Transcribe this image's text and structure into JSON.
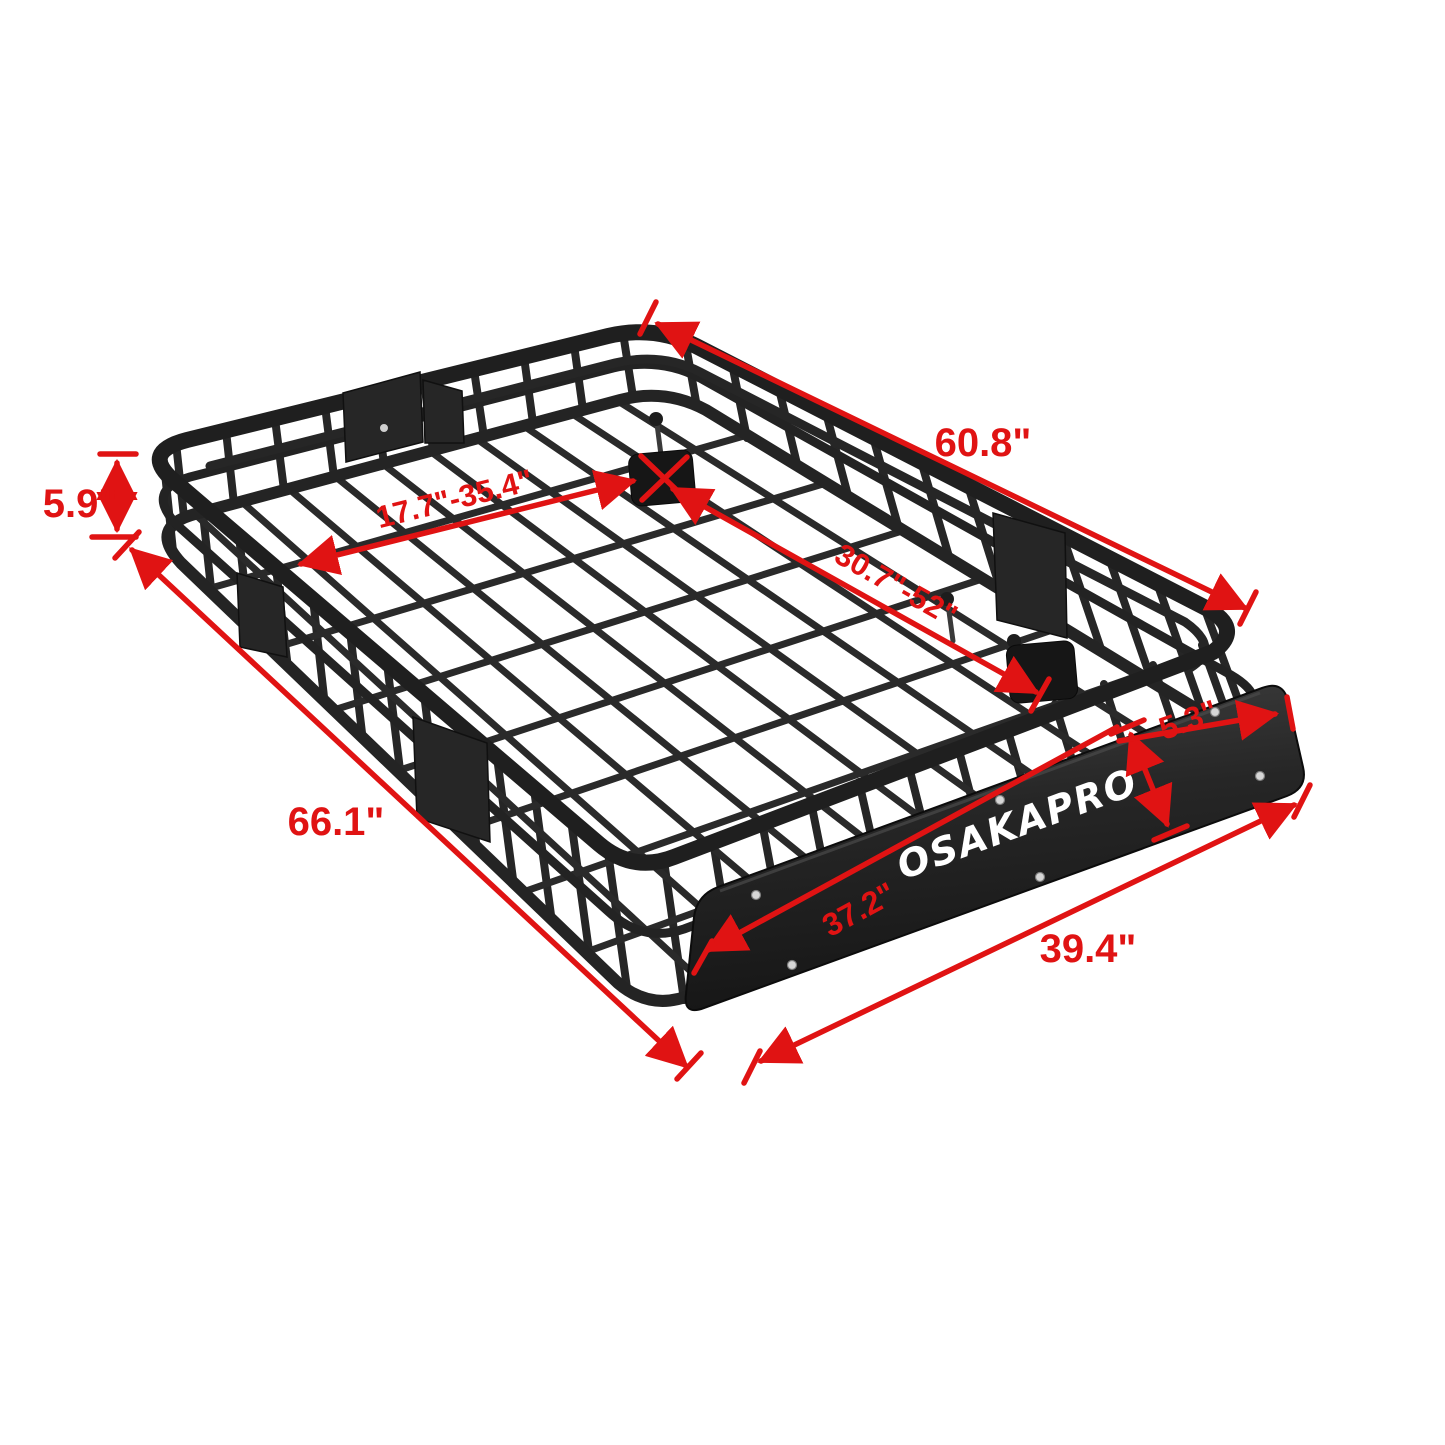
{
  "product": {
    "brand": "OSAKAPRO"
  },
  "colors": {
    "dimension": "#e01313",
    "frame": "#1f1f1f",
    "fairing": "#2c2c2c",
    "logo": "#ffffff",
    "background": "#ffffff"
  },
  "dimensions": {
    "top_length": "60.8\"",
    "basket_height": "5.9\"",
    "side_length": "66.1\"",
    "extension_range": "17.7\"-35.4\"",
    "crossbar_spread": "30.7\"-52\"",
    "fairing_height": "5.3\"",
    "fairing_length": "37.2\"",
    "front_width": "39.4\""
  }
}
